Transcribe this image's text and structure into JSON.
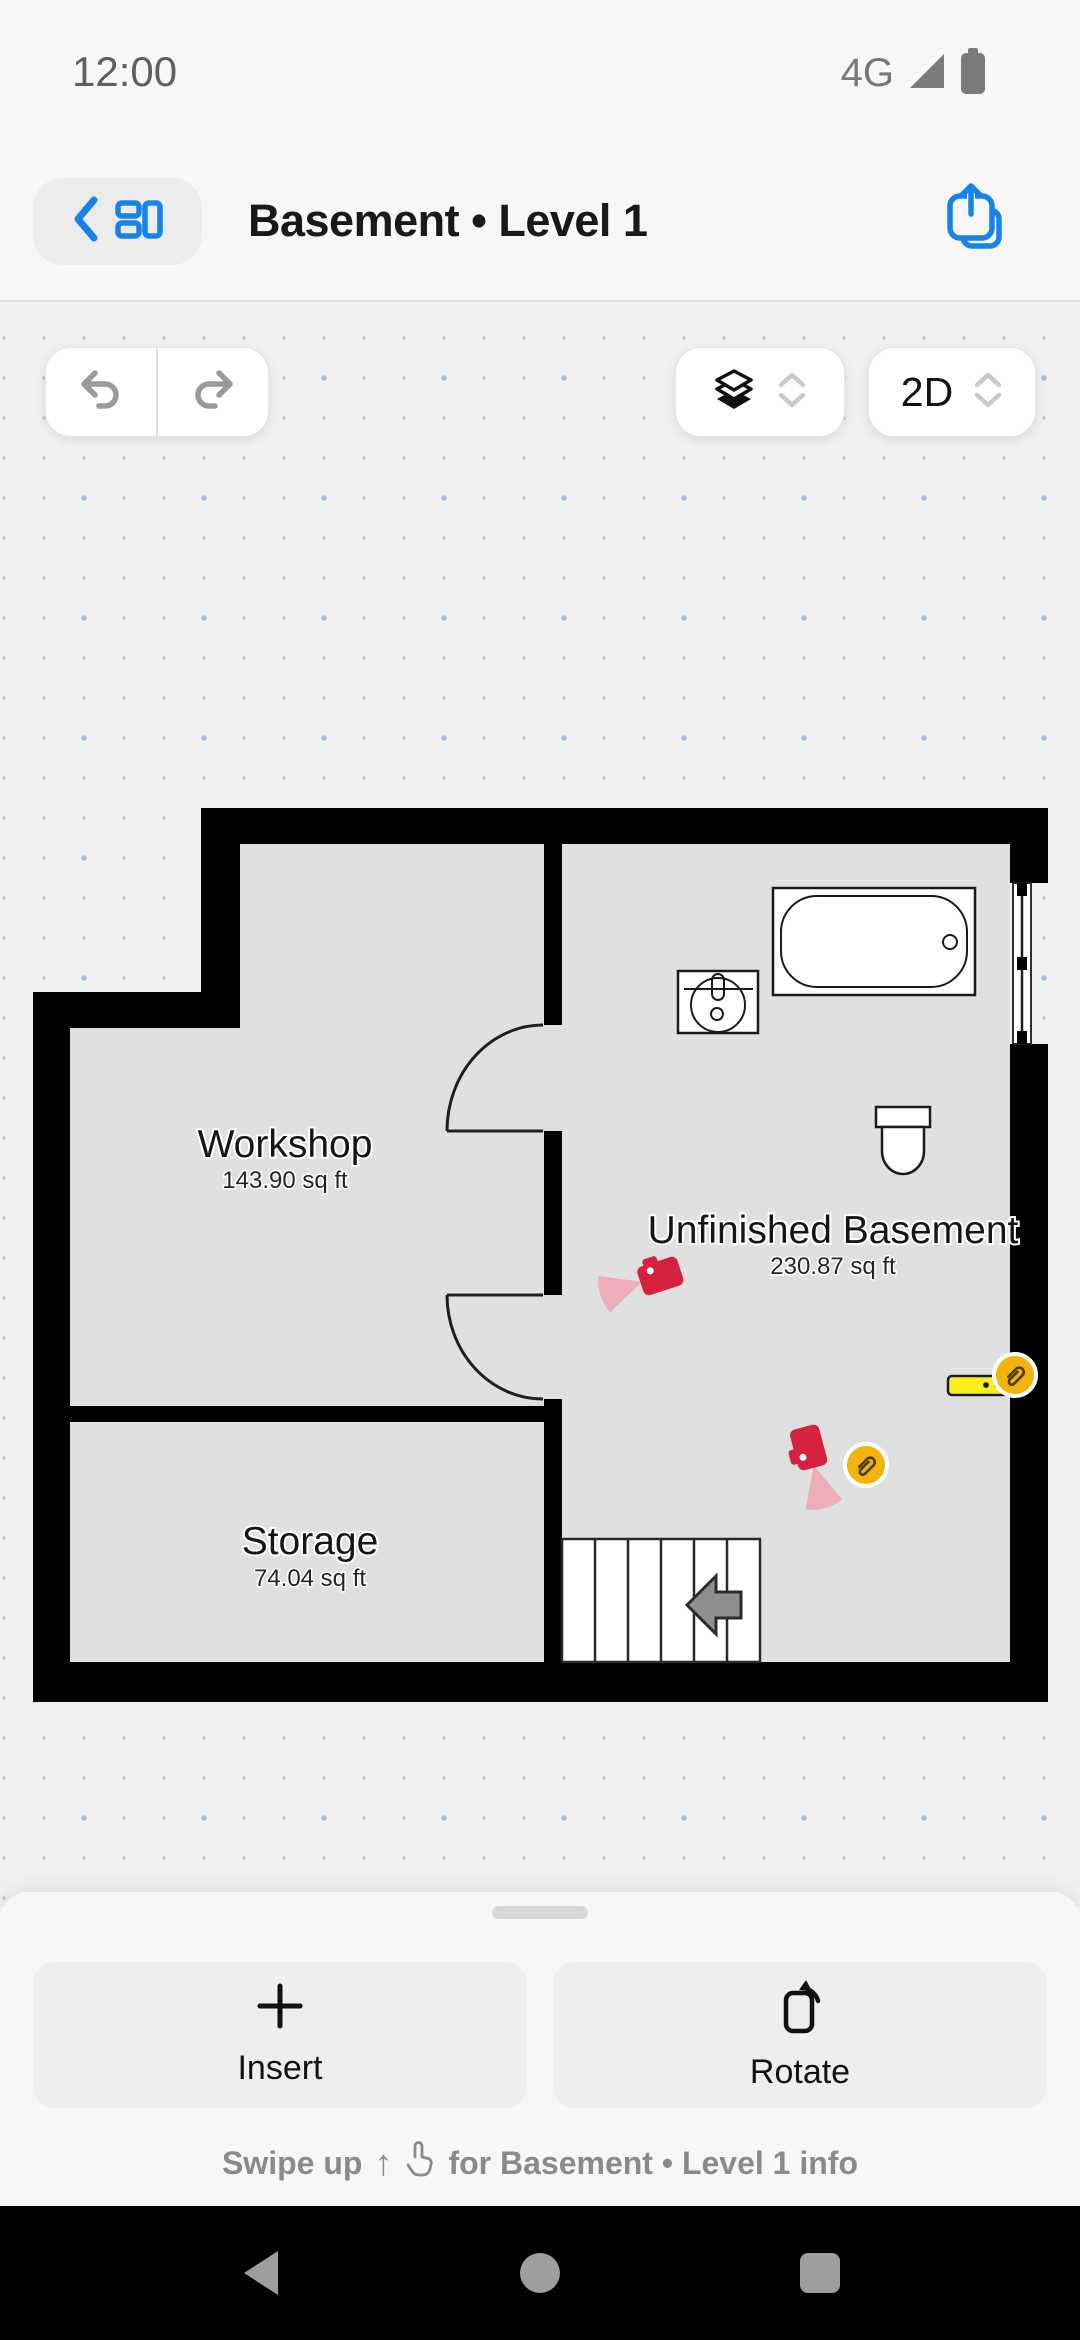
{
  "status_bar": {
    "time": "12:00",
    "network": "4G"
  },
  "header": {
    "title": "Basement • Level 1"
  },
  "toolbar": {
    "view_mode": "2D"
  },
  "plan": {
    "rooms": [
      {
        "name": "Workshop",
        "area": "143.90 sq ft"
      },
      {
        "name": "Unfinished Basement",
        "area": "230.87 sq ft"
      },
      {
        "name": "Storage",
        "area": "74.04 sq ft"
      }
    ]
  },
  "sheet": {
    "insert_label": "Insert",
    "rotate_label": "Rotate",
    "swipe_hint_prefix": "Swipe up",
    "swipe_hint_suffix": "for Basement • Level 1 info"
  },
  "colors": {
    "accent": "#1583ea",
    "wall": "#000000",
    "room_fill": "#e0e0e0",
    "canvas_bg": "#f0f0f1",
    "camera_red": "#d6213f",
    "cone_pink": "#edadba",
    "badge_amber": "#f4b30a",
    "tape_yellow": "#f8ef1c"
  }
}
